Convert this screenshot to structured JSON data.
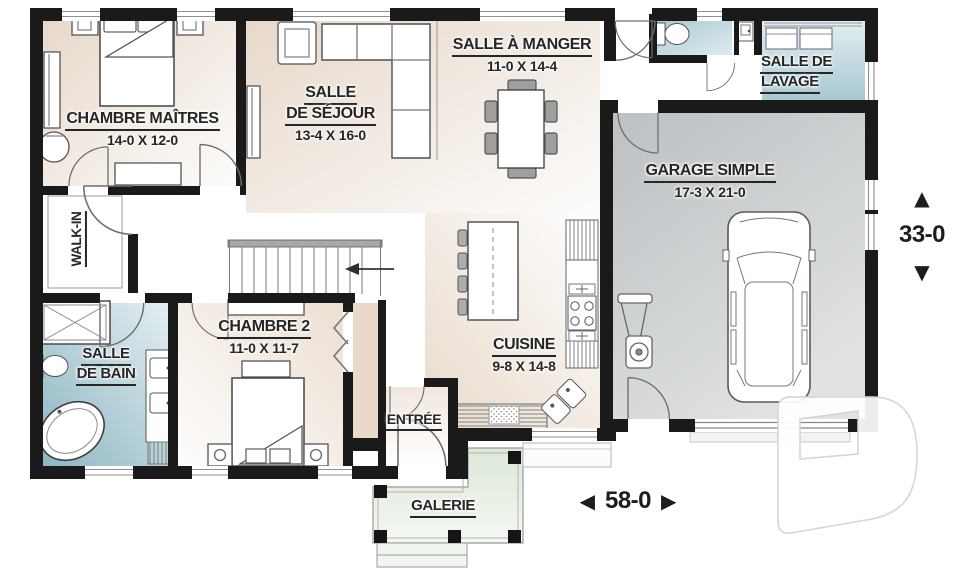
{
  "rooms": {
    "master": {
      "name": "CHAMBRE MAÎTRES",
      "dims": "14-0 X 12-0"
    },
    "living": {
      "name1": "SALLE",
      "name2": "DE SÉJOUR",
      "dims": "13-4 X 16-0"
    },
    "dining": {
      "name": "SALLE À MANGER",
      "dims": "11-0 X 14-4"
    },
    "laundry": {
      "name1": "SALLE DE",
      "name2": "LAVAGE"
    },
    "garage": {
      "name": "GARAGE SIMPLE",
      "dims": "17-3 X 21-0"
    },
    "walkin": {
      "name": "WALK-IN"
    },
    "bedroom2": {
      "name": "CHAMBRE 2",
      "dims": "11-0 X 11-7"
    },
    "bathroom": {
      "name1": "SALLE",
      "name2": "DE BAIN"
    },
    "kitchen": {
      "name": "CUISINE",
      "dims": "9-8 X 14-8"
    },
    "entry": {
      "name": "ENTRÉE"
    },
    "porch": {
      "name": "GALERIE"
    }
  },
  "dimensions": {
    "depth": {
      "value": "33-0",
      "up_arrow": "▲",
      "down_arrow": "▼"
    },
    "width": {
      "value": "58-0",
      "left_arrow": "◀",
      "right_arrow": "▶"
    }
  },
  "colors": {
    "wall": "#1a1a1a",
    "room_beige": "#e7d8ca",
    "wet_room_teal": "#8db6c2",
    "garage_gray": "#bcc0c2",
    "porch_green": "#dce8d8",
    "label_text": "#262626"
  },
  "watermark": {
    "shape": "letter-D-builder-logo"
  }
}
